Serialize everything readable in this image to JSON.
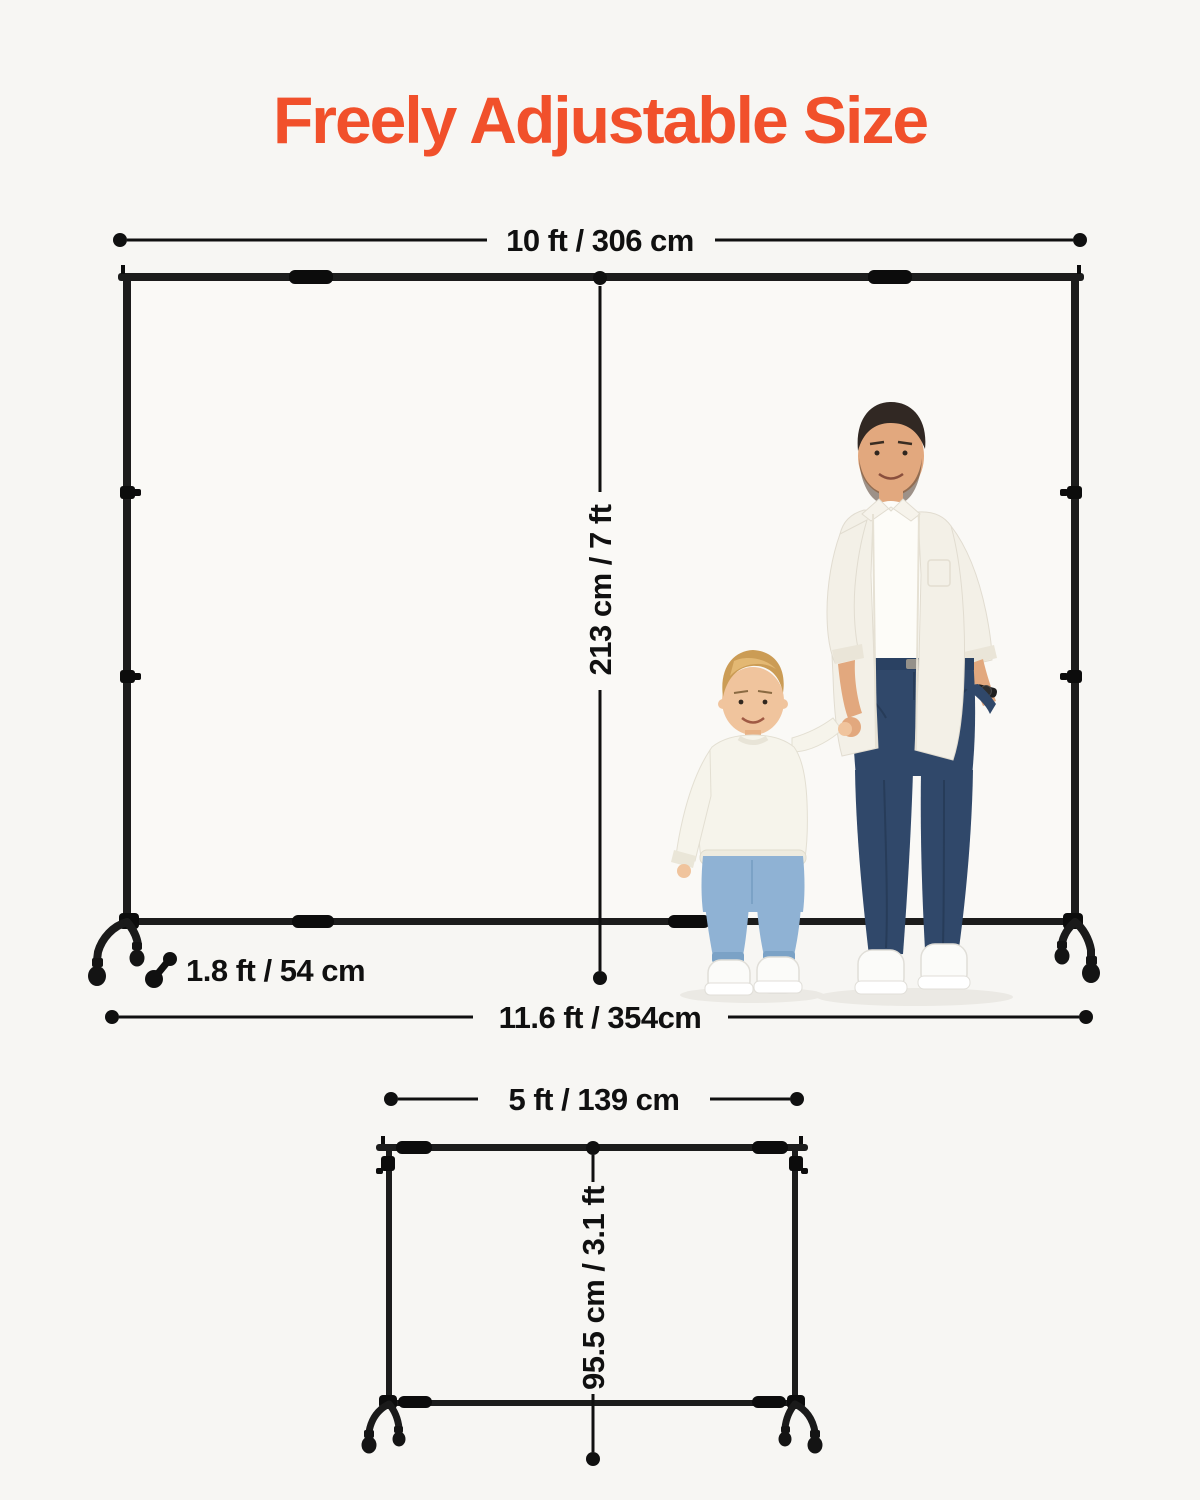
{
  "title": "Freely Adjustable Size",
  "colors": {
    "accent": "#f1502b",
    "ink": "#101010",
    "background": "#f7f6f3",
    "frame": "#1c1c1c"
  },
  "main_stand": {
    "width_label": "10 ft / 306 cm",
    "height_label": "213 cm / 7 ft",
    "base_depth_label": "1.8 ft / 54 cm",
    "footprint_width_label": "11.6 ft / 354cm"
  },
  "small_stand": {
    "width_label": "5 ft / 139 cm",
    "height_label": "95.5 cm / 3.1 ft"
  },
  "icons": {
    "base_depth": "dumbbell-diagonal-icon"
  }
}
